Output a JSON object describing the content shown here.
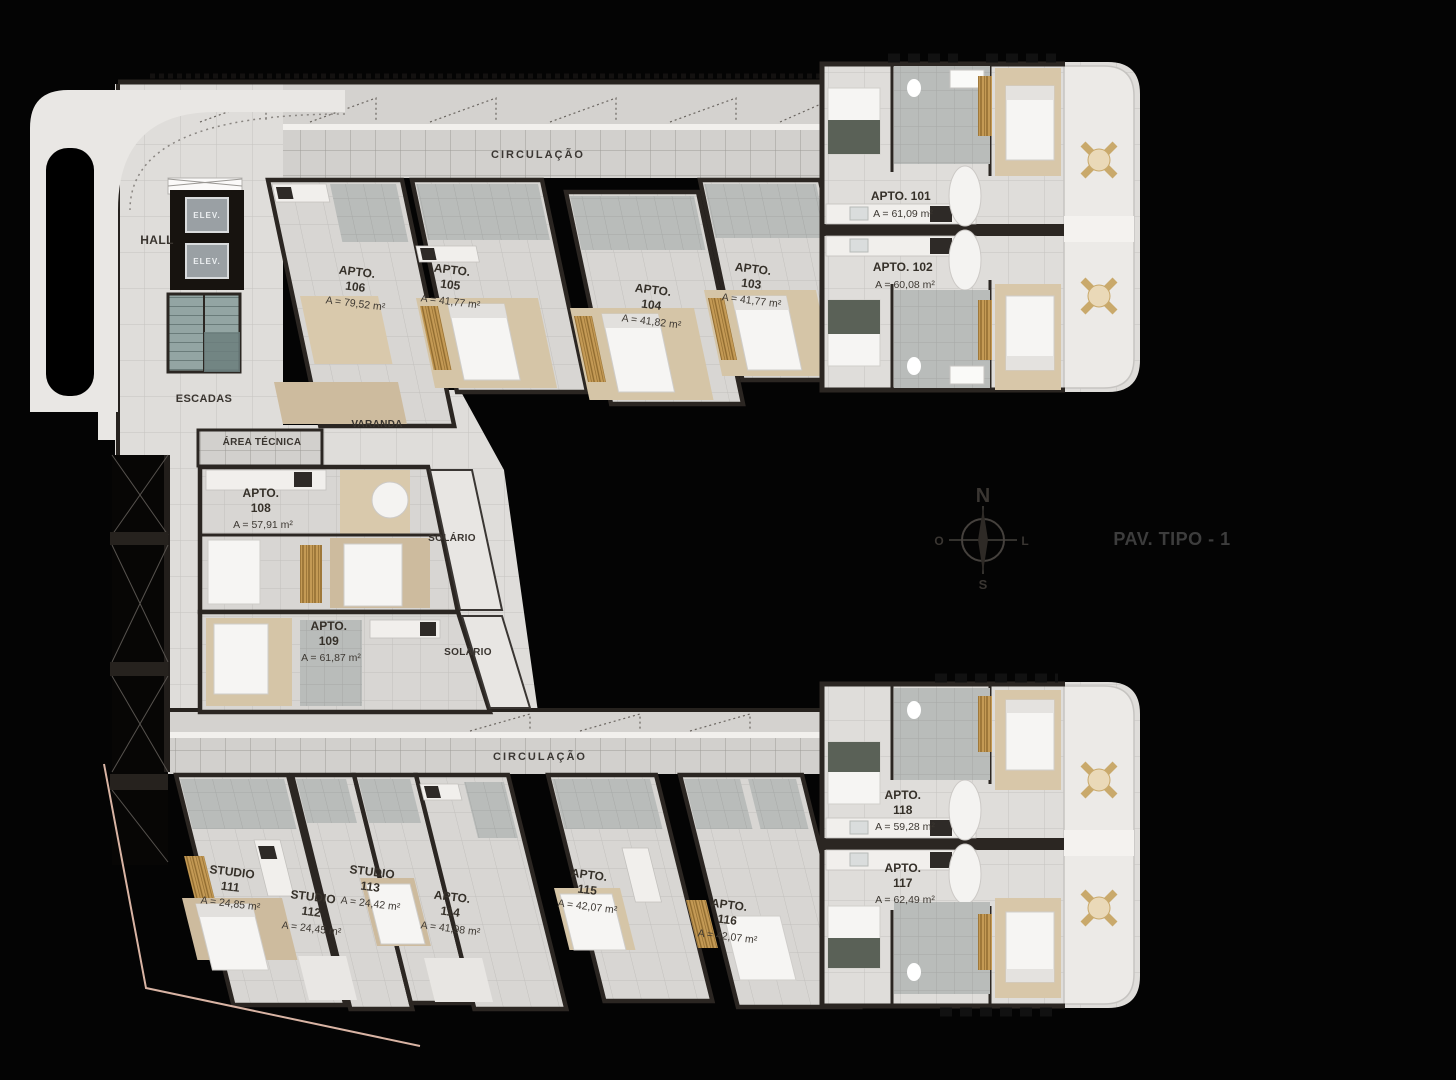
{
  "title": "PAV. TIPO - 1",
  "compass": {
    "north": "N",
    "south": "S",
    "west": "O",
    "east": "L"
  },
  "labels": {
    "circulacao": "CIRCULAÇÃO",
    "hall": "HALL",
    "elev": "ELEV.",
    "escadas": "ESCADAS",
    "area_tecnica": "ÁREA TÉCNICA",
    "varanda": "VARANDA",
    "solario": "SOLÁRIO"
  },
  "units": [
    {
      "id": "101",
      "l1": "APTO. 101",
      "area": "A = 61,09 m²"
    },
    {
      "id": "102",
      "l1": "APTO. 102",
      "area": "A = 60,08 m²"
    },
    {
      "id": "103",
      "l1": "APTO.",
      "l2": "103",
      "area": "A = 41,77 m²"
    },
    {
      "id": "104",
      "l1": "APTO.",
      "l2": "104",
      "area": "A = 41,82 m²"
    },
    {
      "id": "105",
      "l1": "APTO.",
      "l2": "105",
      "area": "A = 41,77 m²"
    },
    {
      "id": "106",
      "l1": "APTO.",
      "l2": "106",
      "area": "A = 79,52 m²"
    },
    {
      "id": "108",
      "l1": "APTO.",
      "l2": "108",
      "area": "A = 57,91 m²"
    },
    {
      "id": "109",
      "l1": "APTO.",
      "l2": "109",
      "area": "A = 61,87 m²"
    },
    {
      "id": "111",
      "l1": "STUDIO",
      "l2": "111",
      "area": "A = 24,85 m²"
    },
    {
      "id": "112",
      "l1": "STUDIO",
      "l2": "112",
      "area": "A = 24,45 m²"
    },
    {
      "id": "113",
      "l1": "STUDIO",
      "l2": "113",
      "area": "A = 24,42 m²"
    },
    {
      "id": "114",
      "l1": "APTO.",
      "l2": "114",
      "area": "A = 41,98 m²"
    },
    {
      "id": "115",
      "l1": "APTO.",
      "l2": "115",
      "area": "A = 42,07 m²"
    },
    {
      "id": "116",
      "l1": "APTO.",
      "l2": "116",
      "area": "A = 42,07 m²"
    },
    {
      "id": "117",
      "l1": "APTO.",
      "l2": "117",
      "area": "A = 62,49 m²"
    },
    {
      "id": "118",
      "l1": "APTO.",
      "l2": "118",
      "area": "A = 59,28 m²"
    }
  ],
  "colors": {
    "background": "#000000",
    "floor": "#dfddda",
    "corridor": "#d2d0cd",
    "wall": "#2b2622",
    "bedroom_floor": "#d5c5a7",
    "wood_closet": "#c49a55",
    "bath_tile": "#b9bcba",
    "balcony": "#eceae7",
    "label_text": "#39342f",
    "site_line": "#d9b4a4"
  }
}
